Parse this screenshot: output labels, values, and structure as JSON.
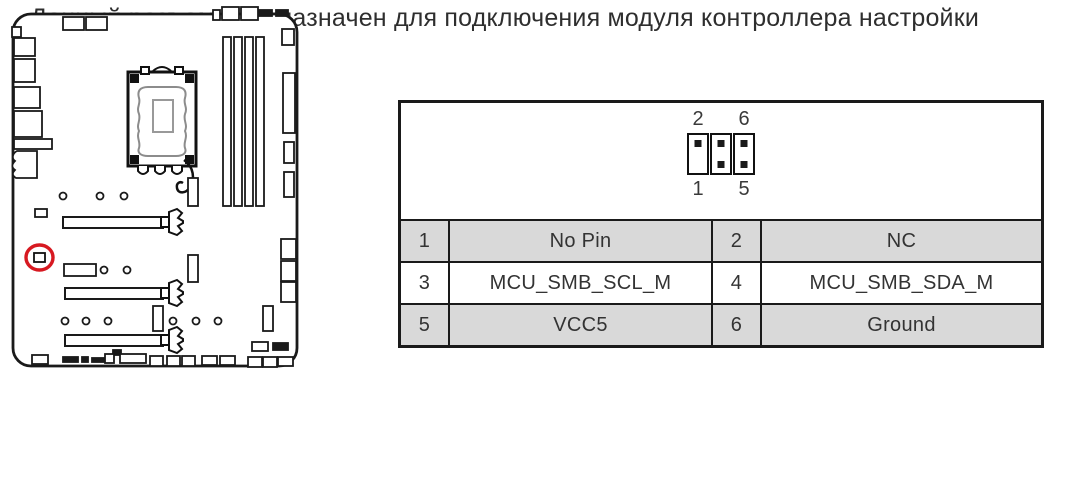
{
  "description": {
    "line1": "Данный разъем предназначен для подключения модуля контроллера настройки",
    "line2": "(опционально)."
  },
  "connector_diagram": {
    "top_left_label": "2",
    "top_right_label": "6",
    "bottom_left_label": "1",
    "bottom_right_label": "5"
  },
  "pin_table": {
    "rows": [
      {
        "pin_a": "1",
        "signal_a": "No Pin",
        "pin_b": "2",
        "signal_b": "NC"
      },
      {
        "pin_a": "3",
        "signal_a": "MCU_SMB_SCL_M",
        "pin_b": "4",
        "signal_b": "MCU_SMB_SDA_M"
      },
      {
        "pin_a": "5",
        "signal_a": "VCC5",
        "pin_b": "6",
        "signal_b": "Ground"
      }
    ]
  },
  "colors": {
    "row_shaded": "#d9d9d9",
    "table_border": "#1a1a1a",
    "line_color": "#1a1a1a",
    "socket_inner_gray": "#8c8c8c",
    "highlight_red": "#d71921",
    "text": "#2e2e2e"
  }
}
